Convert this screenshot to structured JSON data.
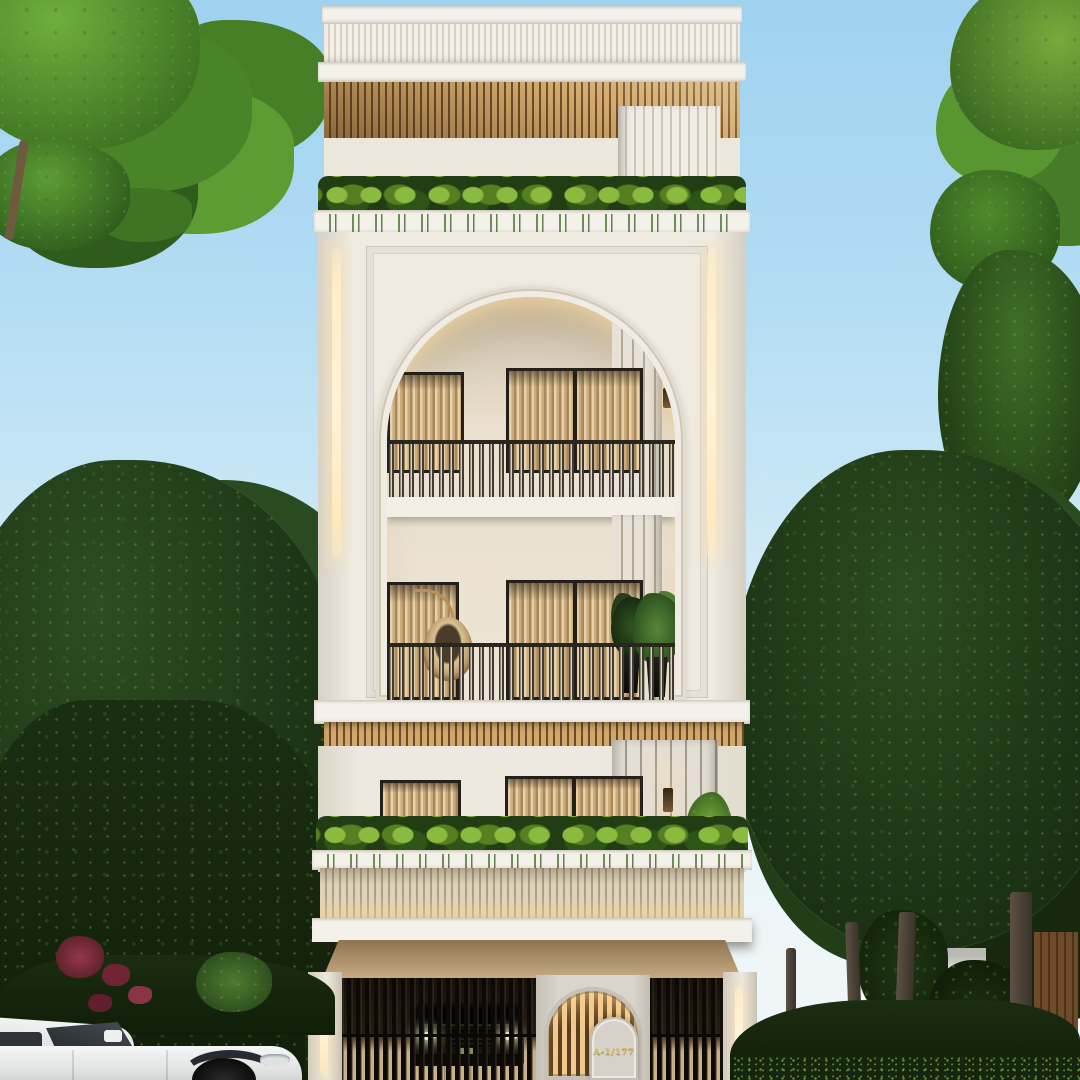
{
  "scene": {
    "caption": "Photorealistic front-elevation render of a modern classic four-level residence at dusk, flanked by trees, with a black SUV behind the entry gate and a white SUV parked on the street",
    "address_plaque": {
      "text": "A-1/177"
    }
  },
  "palette": {
    "sky_top": "#9fd2ef",
    "sky_horizon": "#f1f7f8",
    "facade_cream": "#ece7dd",
    "facade_trim": "#f4f1ea",
    "wood_slat": "#c59c63",
    "wood_slat_dark": "#6d4d28",
    "warm_light": "#ffedc6",
    "curtain": "#c9ab7c",
    "window_frame": "#241f19",
    "railing": "#29261f",
    "foliage_bright": "#6fae3d",
    "foliage_dark": "#1b3114",
    "planter_green": "#8abb3e",
    "gate_dark": "#0c0a07",
    "plaque_gold": "#d9b977",
    "car_black": "#0a0908",
    "car_white": "#eef0f0",
    "flower_red": "#7d2e3f"
  }
}
